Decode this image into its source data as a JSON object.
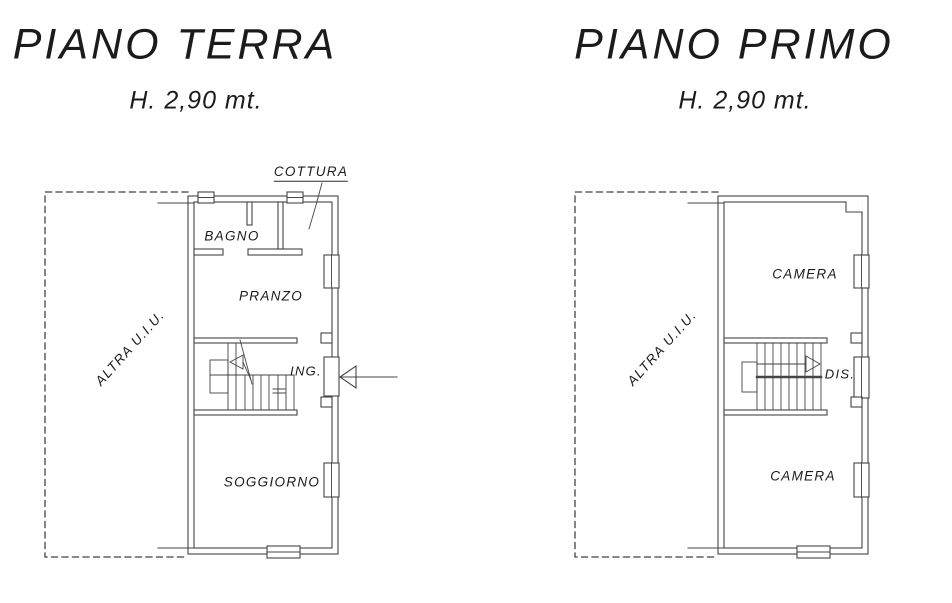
{
  "plans": [
    {
      "id": "piano-terra",
      "title": "PIANO TERRA",
      "height_note": "H. 2,90 mt.",
      "adjacent_unit_label": "ALTRA U.I.U.",
      "rooms": {
        "cottura": "COTTURA",
        "bagno": "BAGNO",
        "pranzo": "PRANZO",
        "ingresso": "ING.",
        "soggiorno": "SOGGIORNO"
      }
    },
    {
      "id": "piano-primo",
      "title": "PIANO PRIMO",
      "height_note": "H. 2,90 mt.",
      "adjacent_unit_label": "ALTRA U.I.U.",
      "rooms": {
        "camera_nord": "CAMERA",
        "disimpegno": "DIS.",
        "camera_sud": "CAMERA"
      }
    }
  ],
  "colors": {
    "background": "#ffffff",
    "line": "#444444",
    "text": "#1b1b1b"
  }
}
